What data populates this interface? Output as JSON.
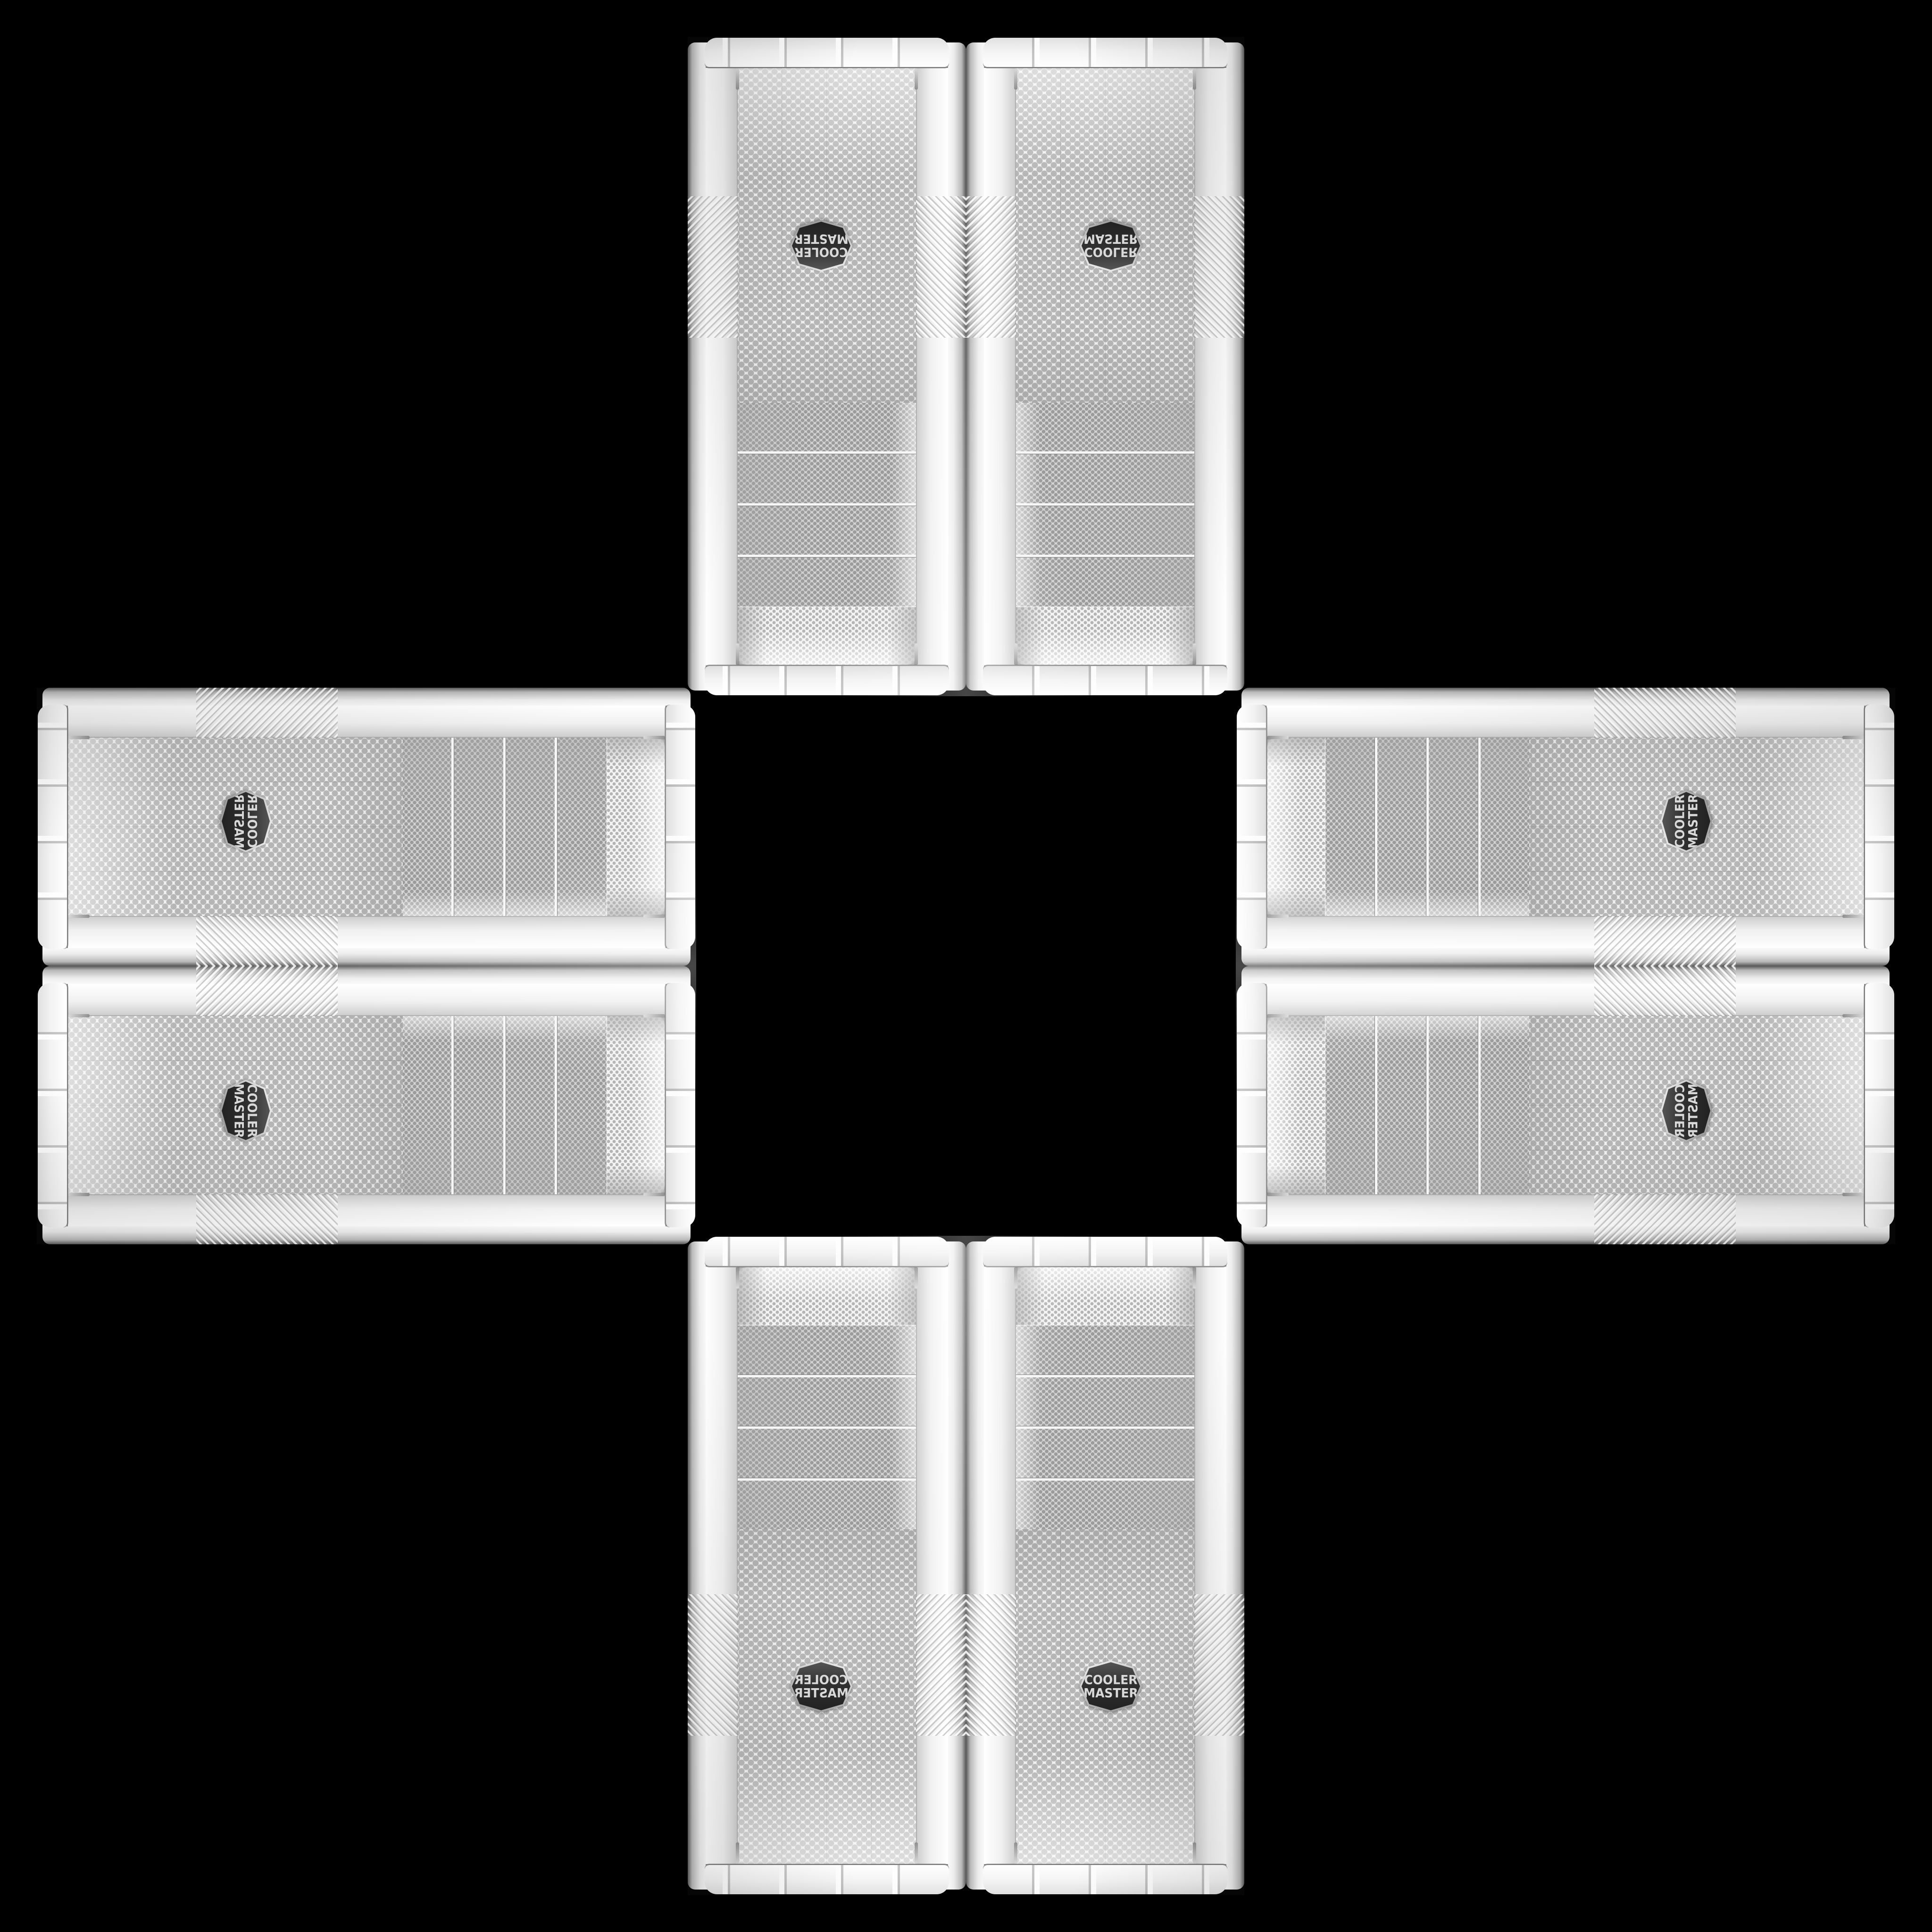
{
  "scene": {
    "background_color": "#000000",
    "layout": "mirrored cross of eight identical white PC tower cases",
    "case_count": 8
  },
  "brand": {
    "line1": "COOLER",
    "line2": "MASTER"
  },
  "case_front": {
    "finish": "white",
    "drive_bay_count": 4,
    "drive_mesh_color": "#d3d3d3",
    "fan_mesh_color": "#f0f0f0",
    "badge_bg": "#303030",
    "badge_text_color": "#d9d9d9",
    "chrome_color": "#9a9a9a"
  },
  "cases": [
    {
      "id": "top-left",
      "orientation": "rot180"
    },
    {
      "id": "top-right",
      "orientation": "flipv"
    },
    {
      "id": "left-top",
      "orientation": "flipv-rot90"
    },
    {
      "id": "right-top",
      "orientation": "rotm90"
    },
    {
      "id": "left-bottom",
      "orientation": "rot90"
    },
    {
      "id": "right-bottom",
      "orientation": "flipv-rotm90"
    },
    {
      "id": "bottom-left",
      "orientation": "fliph"
    },
    {
      "id": "bottom-right",
      "orientation": "none"
    }
  ]
}
